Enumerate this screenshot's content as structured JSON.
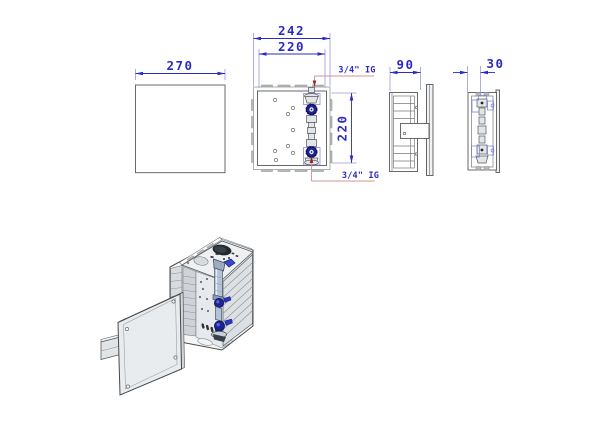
{
  "drawing": {
    "type": "technical-orthographic-drawing",
    "views": {
      "cover_plate": {
        "width_dim": "270"
      },
      "front": {
        "width_outer_dim": "242",
        "width_inner_dim": "220",
        "height_dim": "220",
        "connection_top": "3/4\" IG",
        "connection_bottom": "3/4\" IG"
      },
      "side": {
        "depth_dim": "90"
      },
      "end": {
        "depth_dim": "30"
      }
    },
    "colors": {
      "dimension_blue": "#2b2bc4",
      "extension_blue": "#9a9adf",
      "leader_red": "#cf9494",
      "leader_arrow_red": "#a02020",
      "part_line_grey": "#5a5a5a",
      "tab_grey": "#b5b8bc",
      "valve_blue": "#1d2491",
      "background": "#ffffff"
    }
  }
}
